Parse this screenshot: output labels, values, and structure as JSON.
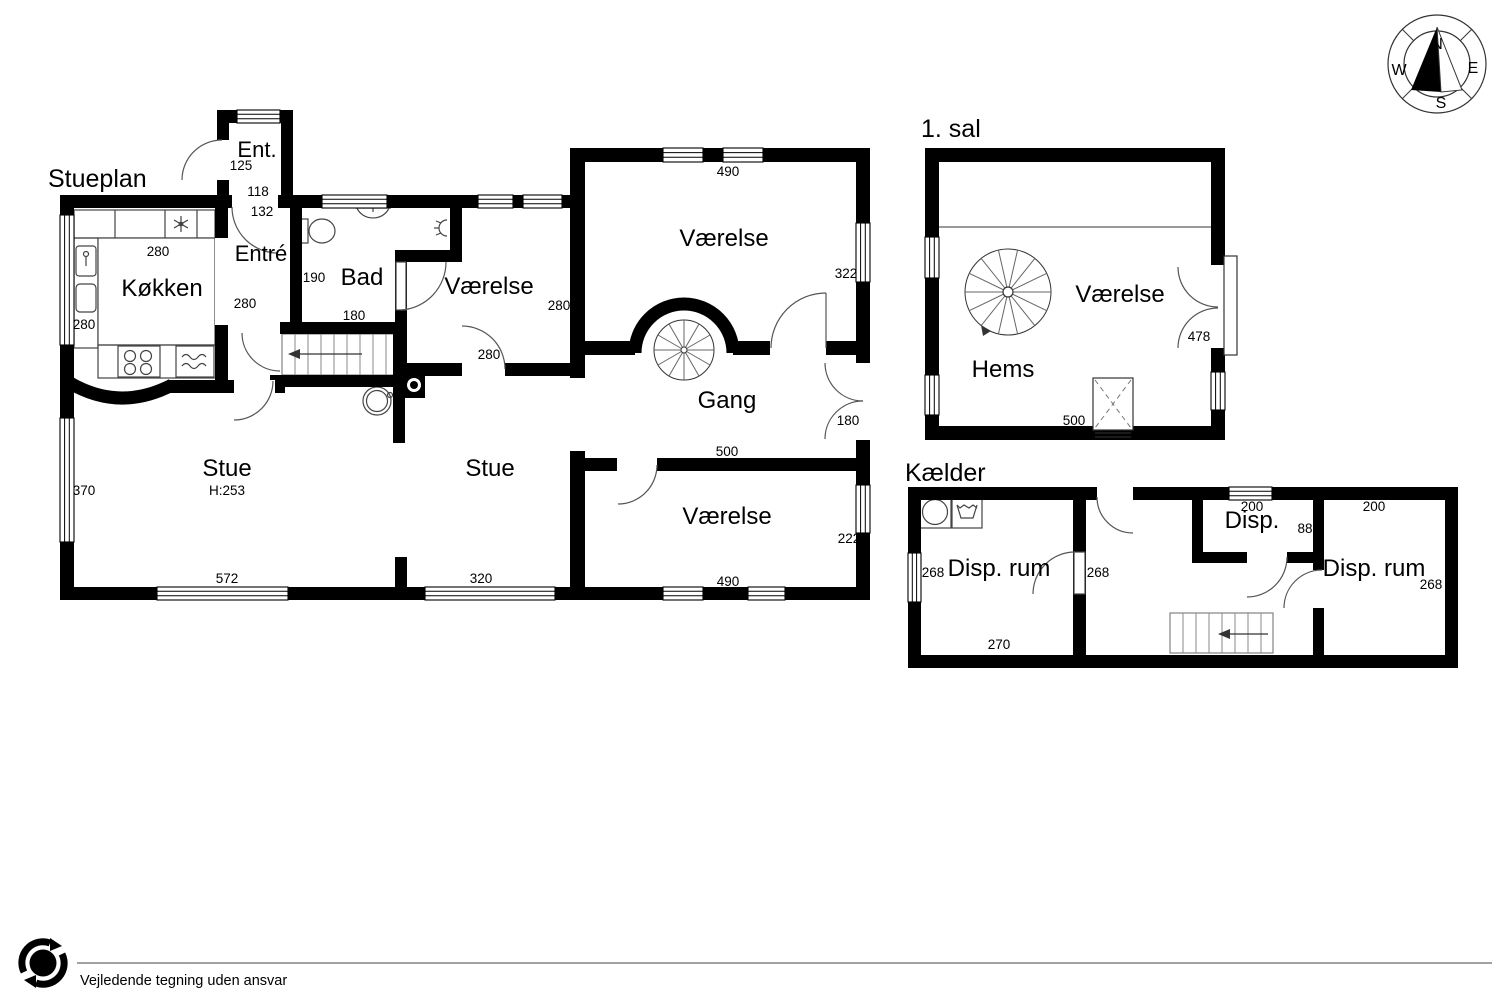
{
  "document": {
    "type": "floor-plan-drawing",
    "footer_disclaimer": "Vejledende tegning uden ansvar",
    "floors": [
      {
        "title": "Stueplan",
        "rooms": [
          "Ent.",
          "Entré",
          "Køkken",
          "Bad",
          "Værelse",
          "Værelse",
          "Gang",
          "Stue",
          "Stue",
          "Værelse"
        ]
      },
      {
        "title": "1. sal",
        "rooms": [
          "Værelse",
          "Hems"
        ]
      },
      {
        "title": "Kælder",
        "rooms": [
          "Disp. rum",
          "Disp.",
          "Disp. rum"
        ]
      }
    ],
    "ceiling_height_note": "H:253"
  },
  "compass": {
    "north": "N",
    "east": "E",
    "south": "S",
    "west": "W"
  },
  "logo": {
    "letter": "e"
  },
  "labels": [
    {
      "name": "title-stueplan",
      "section": "stueplan",
      "text": "Stueplan",
      "x": 48,
      "y": 187,
      "size": 25,
      "anchor": "start"
    },
    {
      "name": "room-ent",
      "section": "stueplan",
      "text": "Ent.",
      "x": 257,
      "y": 157,
      "size": 22,
      "anchor": "middle"
    },
    {
      "name": "dim-ent-125",
      "section": "stueplan",
      "text": "125",
      "x": 241,
      "y": 170,
      "size": 13.5,
      "anchor": "middle"
    },
    {
      "name": "dim-ent-118",
      "section": "stueplan",
      "text": "118",
      "x": 258,
      "y": 196,
      "size": 13.5,
      "anchor": "middle"
    },
    {
      "name": "dim-entre-132",
      "section": "stueplan",
      "text": "132",
      "x": 262,
      "y": 216,
      "size": 13.5,
      "anchor": "middle"
    },
    {
      "name": "room-entre",
      "section": "stueplan",
      "text": "Entré",
      "x": 261,
      "y": 261,
      "size": 22,
      "anchor": "middle"
    },
    {
      "name": "room-kokken",
      "section": "stueplan",
      "text": "Køkken",
      "x": 162,
      "y": 296,
      "size": 24,
      "anchor": "middle"
    },
    {
      "name": "dim-kokken-top-280",
      "section": "stueplan",
      "text": "280",
      "x": 158,
      "y": 256,
      "size": 13.5,
      "anchor": "middle"
    },
    {
      "name": "dim-kokken-left-280",
      "section": "stueplan",
      "text": "280",
      "x": 84,
      "y": 329,
      "size": 13.5,
      "anchor": "middle"
    },
    {
      "name": "dim-kokken-east-280",
      "section": "stueplan",
      "text": "280",
      "x": 245,
      "y": 308,
      "size": 13.5,
      "anchor": "middle"
    },
    {
      "name": "room-bad",
      "section": "stueplan",
      "text": "Bad",
      "x": 362,
      "y": 285,
      "size": 24,
      "anchor": "middle"
    },
    {
      "name": "dim-bad-190",
      "section": "stueplan",
      "text": "190",
      "x": 314,
      "y": 282,
      "size": 13.5,
      "anchor": "middle"
    },
    {
      "name": "dim-bad-180",
      "section": "stueplan",
      "text": "180",
      "x": 354,
      "y": 320,
      "size": 13.5,
      "anchor": "middle"
    },
    {
      "name": "room-vaerelse-left",
      "section": "stueplan",
      "text": "Værelse",
      "x": 489,
      "y": 294,
      "size": 24,
      "anchor": "middle"
    },
    {
      "name": "dim-vaerelse-left-e-280",
      "section": "stueplan",
      "text": "280",
      "x": 559,
      "y": 310,
      "size": 13.5,
      "anchor": "middle"
    },
    {
      "name": "dim-vaerelse-left-s-280",
      "section": "stueplan",
      "text": "280",
      "x": 489,
      "y": 359,
      "size": 13.5,
      "anchor": "middle"
    },
    {
      "name": "room-vaerelse-top",
      "section": "stueplan",
      "text": "Værelse",
      "x": 724,
      "y": 246,
      "size": 24,
      "anchor": "middle"
    },
    {
      "name": "dim-vaerelse-top-490",
      "section": "stueplan",
      "text": "490",
      "x": 728,
      "y": 176,
      "size": 13.5,
      "anchor": "middle"
    },
    {
      "name": "dim-vaerelse-top-322",
      "section": "stueplan",
      "text": "322",
      "x": 846,
      "y": 278,
      "size": 13.5,
      "anchor": "middle"
    },
    {
      "name": "room-gang",
      "section": "stueplan",
      "text": "Gang",
      "x": 727,
      "y": 408,
      "size": 24,
      "anchor": "middle"
    },
    {
      "name": "dim-gang-180",
      "section": "stueplan",
      "text": "180",
      "x": 848,
      "y": 425,
      "size": 13.5,
      "anchor": "middle"
    },
    {
      "name": "dim-gang-500",
      "section": "stueplan",
      "text": "500",
      "x": 727,
      "y": 456,
      "size": 13.5,
      "anchor": "middle"
    },
    {
      "name": "room-stue-1",
      "section": "stueplan",
      "text": "Stue",
      "x": 227,
      "y": 476,
      "size": 24,
      "anchor": "middle"
    },
    {
      "name": "dim-stue-h253",
      "section": "stueplan",
      "text": "H:253",
      "x": 227,
      "y": 495,
      "size": 13.5,
      "anchor": "middle"
    },
    {
      "name": "dim-stue-370",
      "section": "stueplan",
      "text": "370",
      "x": 84,
      "y": 495,
      "size": 13.5,
      "anchor": "middle"
    },
    {
      "name": "dim-stue-572",
      "section": "stueplan",
      "text": "572",
      "x": 227,
      "y": 583,
      "size": 13.5,
      "anchor": "middle"
    },
    {
      "name": "room-stue-2",
      "section": "stueplan",
      "text": "Stue",
      "x": 490,
      "y": 476,
      "size": 24,
      "anchor": "middle"
    },
    {
      "name": "dim-stue2-320",
      "section": "stueplan",
      "text": "320",
      "x": 481,
      "y": 583,
      "size": 13.5,
      "anchor": "middle"
    },
    {
      "name": "room-vaerelse-bottom",
      "section": "stueplan",
      "text": "Værelse",
      "x": 727,
      "y": 524,
      "size": 24,
      "anchor": "middle"
    },
    {
      "name": "dim-vaerelse-bottom-222",
      "section": "stueplan",
      "text": "222",
      "x": 849,
      "y": 543,
      "size": 13.5,
      "anchor": "middle"
    },
    {
      "name": "dim-vaerelse-bottom-490",
      "section": "stueplan",
      "text": "490",
      "x": 728,
      "y": 586,
      "size": 13.5,
      "anchor": "middle"
    },
    {
      "name": "title-first-floor",
      "section": "first_floor",
      "text": "1. sal",
      "x": 921,
      "y": 137,
      "size": 25,
      "anchor": "start"
    },
    {
      "name": "room-vaerelse-1sal",
      "section": "first_floor",
      "text": "Værelse",
      "x": 1120,
      "y": 302,
      "size": 24,
      "anchor": "middle"
    },
    {
      "name": "room-hems",
      "section": "first_floor",
      "text": "Hems",
      "x": 1003,
      "y": 377,
      "size": 24,
      "anchor": "middle"
    },
    {
      "name": "dim-1sal-478",
      "section": "first_floor",
      "text": "478",
      "x": 1199,
      "y": 341,
      "size": 13.5,
      "anchor": "middle"
    },
    {
      "name": "dim-1sal-500",
      "section": "first_floor",
      "text": "500",
      "x": 1074,
      "y": 425,
      "size": 13.5,
      "anchor": "middle"
    },
    {
      "name": "title-basement",
      "section": "basement",
      "text": "Kælder",
      "x": 905,
      "y": 481,
      "size": 25,
      "anchor": "start"
    },
    {
      "name": "room-disp-rum-left",
      "section": "basement",
      "text": "Disp. rum",
      "x": 999,
      "y": 576,
      "size": 24,
      "anchor": "middle"
    },
    {
      "name": "dim-kaelder-268-left",
      "section": "basement",
      "text": "268",
      "x": 933,
      "y": 577,
      "size": 13.5,
      "anchor": "middle"
    },
    {
      "name": "dim-kaelder-268-mid",
      "section": "basement",
      "text": "268",
      "x": 1098,
      "y": 577,
      "size": 13.5,
      "anchor": "middle"
    },
    {
      "name": "dim-kaelder-270",
      "section": "basement",
      "text": "270",
      "x": 999,
      "y": 649,
      "size": 13.5,
      "anchor": "middle"
    },
    {
      "name": "room-disp",
      "section": "basement",
      "text": "Disp.",
      "x": 1252,
      "y": 528,
      "size": 24,
      "anchor": "middle"
    },
    {
      "name": "dim-disp-200",
      "section": "basement",
      "text": "200",
      "x": 1252,
      "y": 511,
      "size": 13.5,
      "anchor": "middle"
    },
    {
      "name": "dim-disp-88",
      "section": "basement",
      "text": "88",
      "x": 1305,
      "y": 533,
      "size": 13.5,
      "anchor": "middle"
    },
    {
      "name": "room-disp-rum-right",
      "section": "basement",
      "text": "Disp. rum",
      "x": 1374,
      "y": 576,
      "size": 24,
      "anchor": "middle"
    },
    {
      "name": "dim-kaelder-200-right",
      "section": "basement",
      "text": "200",
      "x": 1374,
      "y": 511,
      "size": 13.5,
      "anchor": "middle"
    },
    {
      "name": "dim-kaelder-268-right",
      "section": "basement",
      "text": "268",
      "x": 1431,
      "y": 589,
      "size": 13.5,
      "anchor": "middle"
    },
    {
      "name": "compass-n",
      "section": "compass",
      "text": "N",
      "x": 1437,
      "y": 49,
      "size": 16,
      "anchor": "middle"
    },
    {
      "name": "compass-e",
      "section": "compass",
      "text": "E",
      "x": 1473,
      "y": 73,
      "size": 16,
      "anchor": "middle"
    },
    {
      "name": "compass-s",
      "section": "compass",
      "text": "S",
      "x": 1441,
      "y": 108,
      "size": 16,
      "anchor": "middle"
    },
    {
      "name": "compass-w",
      "section": "compass",
      "text": "W",
      "x": 1399,
      "y": 75,
      "size": 16,
      "anchor": "middle"
    },
    {
      "name": "logo-letter",
      "section": "logo",
      "text": "e",
      "x": 43,
      "y": 971,
      "size": 21,
      "anchor": "middle",
      "color": "#ffffff",
      "bold": true
    },
    {
      "name": "footer-disclaimer",
      "section": "footer",
      "text": "Vejledende tegning uden ansvar",
      "x": 80,
      "y": 985,
      "size": 14.5,
      "anchor": "start"
    }
  ]
}
